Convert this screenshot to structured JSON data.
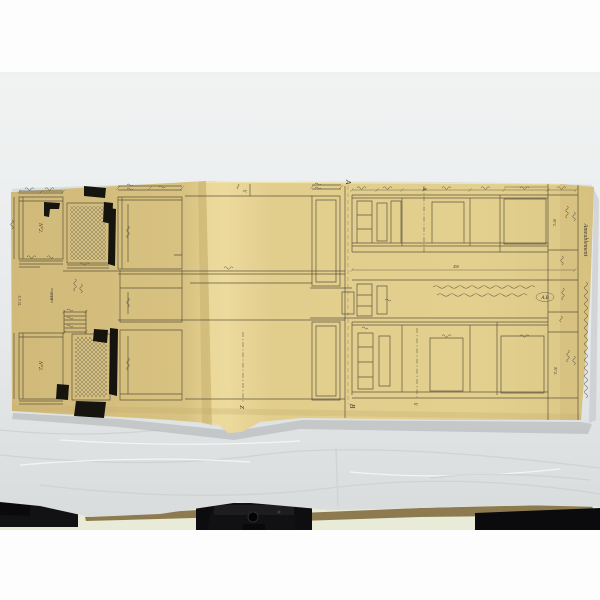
{
  "photo": {
    "subject": "Antique folded technical drawing on yellowed paper, photographed on white tissue paper over a dark table edge with camera-mount hardware"
  },
  "drawing": {
    "labels": {
      "section_top": "A",
      "section_bottom": "B",
      "axis_x": "X",
      "axis_y": "Y",
      "axis_y_center": "Y",
      "axis_z": "Z"
    },
    "parts": {
      "left_upper": "N°2.",
      "left_lower": "N°2.",
      "margin_upper": "N°1.",
      "margin_lower": "N°2."
    },
    "annotations": {
      "ref": "A.B",
      "dim_overall": "450",
      "scale": "1/10",
      "date_code": "5.7.31.",
      "title_script": "Ameublement"
    }
  }
}
